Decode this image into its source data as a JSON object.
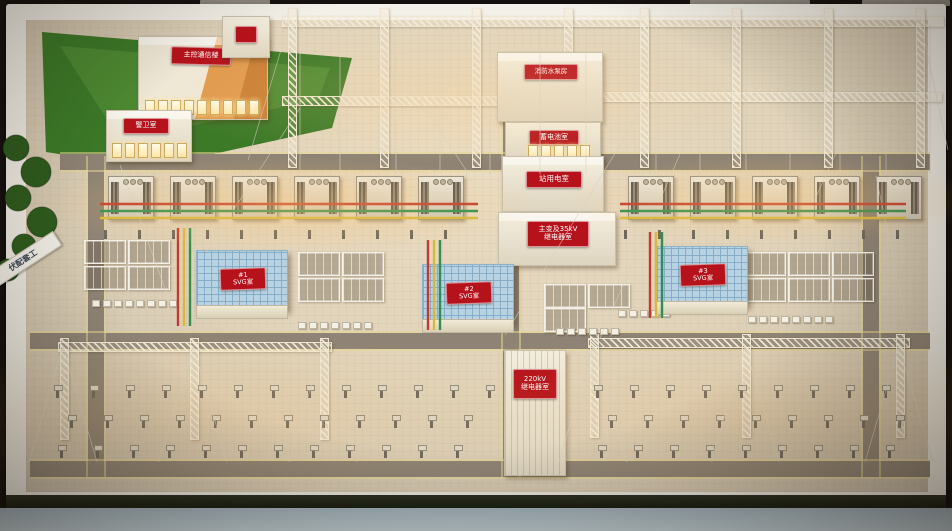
{
  "scene": {
    "subject": "220kV photovoltaic substation physical scale model on display table"
  },
  "signs": {
    "control_building": "主控通信楼",
    "guard_room": "警卫室",
    "fire_pump_house": "消防水泵房",
    "battery_room": "蓄电池室",
    "station_service_room": "站用电室",
    "main_transformer_relay": {
      "line1": "主变及35kV",
      "line2": "继电器室"
    },
    "svg_room_1": {
      "line1": "#1",
      "line2": "SVG室"
    },
    "svg_room_2": {
      "line1": "#2",
      "line2": "SVG室"
    },
    "svg_room_3": {
      "line1": "#3",
      "line2": "SVG室"
    },
    "relay_room_220kv": {
      "line1": "220kV",
      "line2": "继电器室"
    },
    "project_nameplate": "伏配套工"
  },
  "colors": {
    "sign_red": "#b5121b",
    "sign_text": "#ffffff",
    "grass": "#3c7a28",
    "tree": "#2e5c1d",
    "yard": "#eadcc2",
    "road": "#8e8374",
    "road_line": "#e6d692",
    "busbar_red": "#c23b2e",
    "busbar_green": "#2f8f4e",
    "busbar_yellow": "#d8b93c",
    "truss_cream": "#f0e8d4",
    "svg_roof": "#b7d2e2",
    "orange_building": "#d8923f",
    "table_front": "#c2d0d5",
    "wire": "#d8d1c2"
  }
}
